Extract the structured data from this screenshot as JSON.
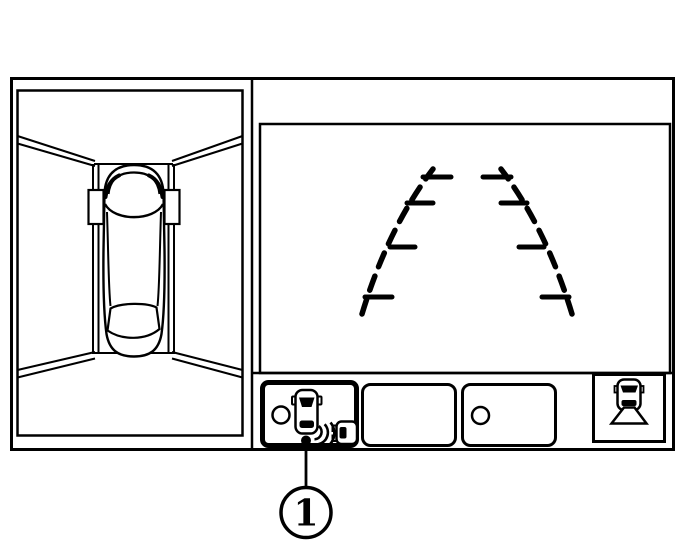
{
  "figure": {
    "type": "vehicle-display-illustration",
    "callout": {
      "number": "1"
    }
  },
  "colors": {
    "line": "#000000",
    "background": "#ffffff"
  },
  "panels": {
    "left": {
      "name": "birds-eye-view",
      "icons": [
        "top-view-car-icon",
        "parking-bay-lines",
        "mirror-marker",
        "mirror-marker"
      ]
    },
    "right": {
      "name": "rear-camera-view",
      "icons": [
        "predicted-path-guideline-left",
        "predicted-path-guideline-right"
      ]
    }
  },
  "toolbar": {
    "buttons": [
      {
        "icon": "sonar-cross-traffic-icon",
        "selected": true
      },
      {
        "icon": "blank",
        "selected": false
      },
      {
        "icon": "indicator-circle-icon",
        "selected": false
      },
      {
        "icon": "camera-view-switch-icon",
        "selected": false
      }
    ]
  }
}
